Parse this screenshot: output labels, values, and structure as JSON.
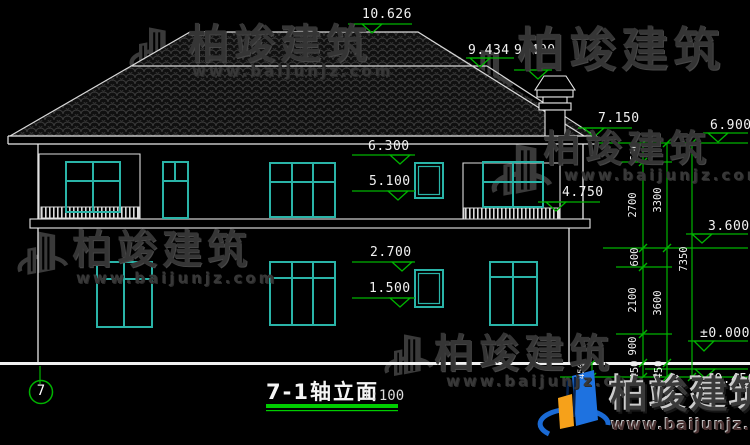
{
  "drawing": {
    "title": "7-1轴立面",
    "scale": "1:100",
    "axis_bubble": "7"
  },
  "markers": {
    "m10626": "10.626",
    "m9434": "9.434",
    "m9400": "9.400",
    "m7150": "7.150",
    "m6900": "6.900",
    "m6300": "6.300",
    "m5100": "5.100",
    "m4750": "4.750",
    "m3600": "3.600",
    "m2700": "2.700",
    "m1500": "1.500",
    "m0": "±0.000",
    "mn450": "-0.450"
  },
  "vdims": {
    "a600": "600",
    "a2700": "2700",
    "b600": "600",
    "a2100": "2100",
    "a900": "900",
    "a450": "450",
    "a3300": "3300",
    "a3600": "3600",
    "b450": "450",
    "a7350": "7350",
    "c450": "450"
  },
  "watermark": {
    "brand": "柏竣建筑",
    "url": "www.baijunjz.com"
  },
  "footer": {
    "brand": "柏竣建筑",
    "url": "www.baijunjz.com"
  },
  "colors": {
    "background": "#000000",
    "linework": "#e8e8e8",
    "window": "#2ab4a8",
    "dimension_green": "#00b400",
    "watermark_gray": "#3a3a3a",
    "logo_blue": "#1a6ad4",
    "logo_orange": "#f6a11a"
  }
}
